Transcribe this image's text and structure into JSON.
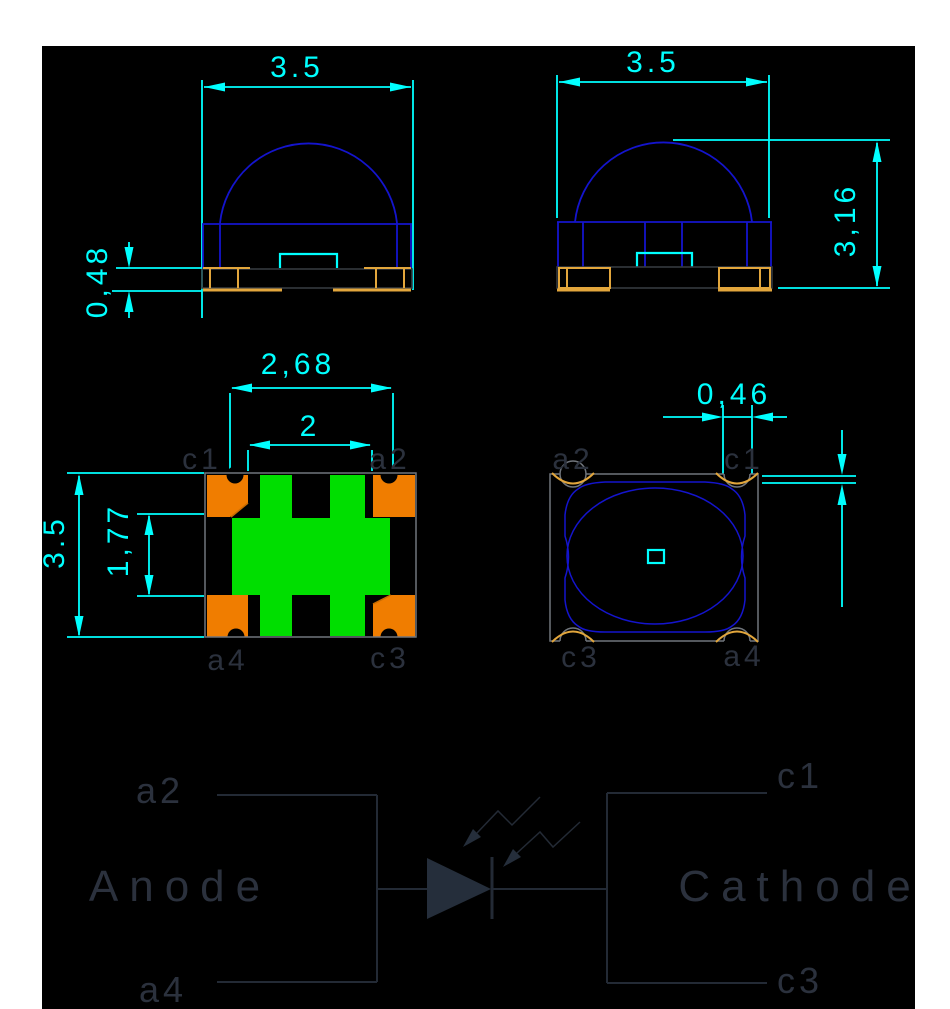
{
  "title": "SMD LED package technical drawing",
  "dims": {
    "front_width": "3.5",
    "front_pad_height": "0,48",
    "side_width": "3.5",
    "side_height": "3,16",
    "footprint_outer_width": "2,68",
    "footprint_inner_width": "2",
    "footprint_height": "3.5",
    "footprint_band_height": "1,77",
    "top_notch_width": "0,46",
    "top_edge_offset": "0,15"
  },
  "footprint_labels": {
    "tl": "c1",
    "tr": "a2",
    "bl": "a4",
    "br": "c3"
  },
  "top_labels": {
    "tl": "a2",
    "tr": "c1",
    "bl": "c3",
    "br": "a4"
  },
  "schematic": {
    "anode": "Anode",
    "cathode": "Cathode",
    "pin_a2": "a2",
    "pin_a4": "a4",
    "pin_c1": "c1",
    "pin_c3": "c3"
  },
  "colors": {
    "background": "#ffffff",
    "canvas": "#000000",
    "dimension": "#00ffff",
    "outline_blue": "#1414cd",
    "gold": "#e2a63c",
    "pad_orange": "#f07d00",
    "pad_green": "#00de00",
    "body_gray": "#70757c",
    "dark_gray": "#35393f",
    "label_slate": "#2b313d",
    "schematic_line": "#232a35",
    "schematic_fill": "#252e3b"
  }
}
